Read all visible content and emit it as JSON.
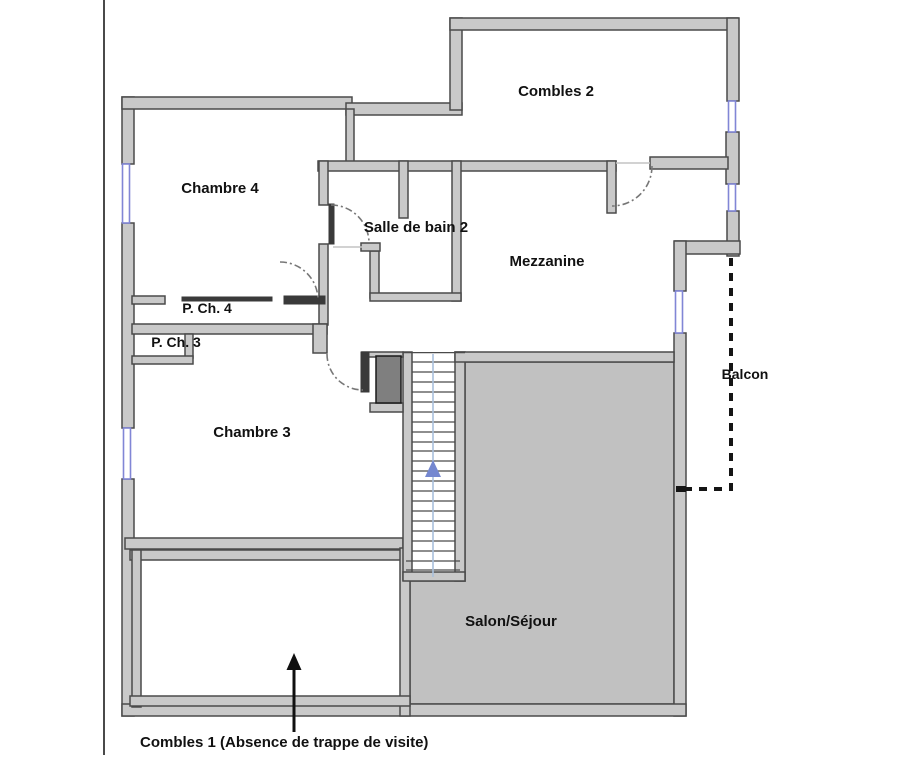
{
  "rooms": {
    "combles2": {
      "label": "Combles 2"
    },
    "chambre4": {
      "label": "Chambre 4"
    },
    "salle_de_bain2": {
      "label": "Salle de bain 2"
    },
    "mezzanine": {
      "label": "Mezzanine"
    },
    "p_ch_4": {
      "label": "P. Ch. 4"
    },
    "p_ch_3": {
      "label": "P. Ch. 3"
    },
    "chambre3": {
      "label": "Chambre 3"
    },
    "balcon": {
      "label": "Balcon"
    },
    "salon_sejour": {
      "label": "Salon/Séjour"
    }
  },
  "annotations": {
    "combles1": {
      "label": "Combles 1 (Absence de trappe de visite)"
    }
  },
  "colors": {
    "background": "#ffffff",
    "wall_fill": "#c9c9c9",
    "wall_edge": "#4a4a4a",
    "wall_dark": "#3a3a3a",
    "window_blue": "#8186d6",
    "salon_fill": "#c1c1c1",
    "salon_edge": "#5a5a5a",
    "flue_fill": "#7f7f7f",
    "stair_guide": "#a9c0dc",
    "stair_arrow": "#7487d0",
    "door_arc": "#777777",
    "balcony": "#151515",
    "text": "#111111"
  }
}
